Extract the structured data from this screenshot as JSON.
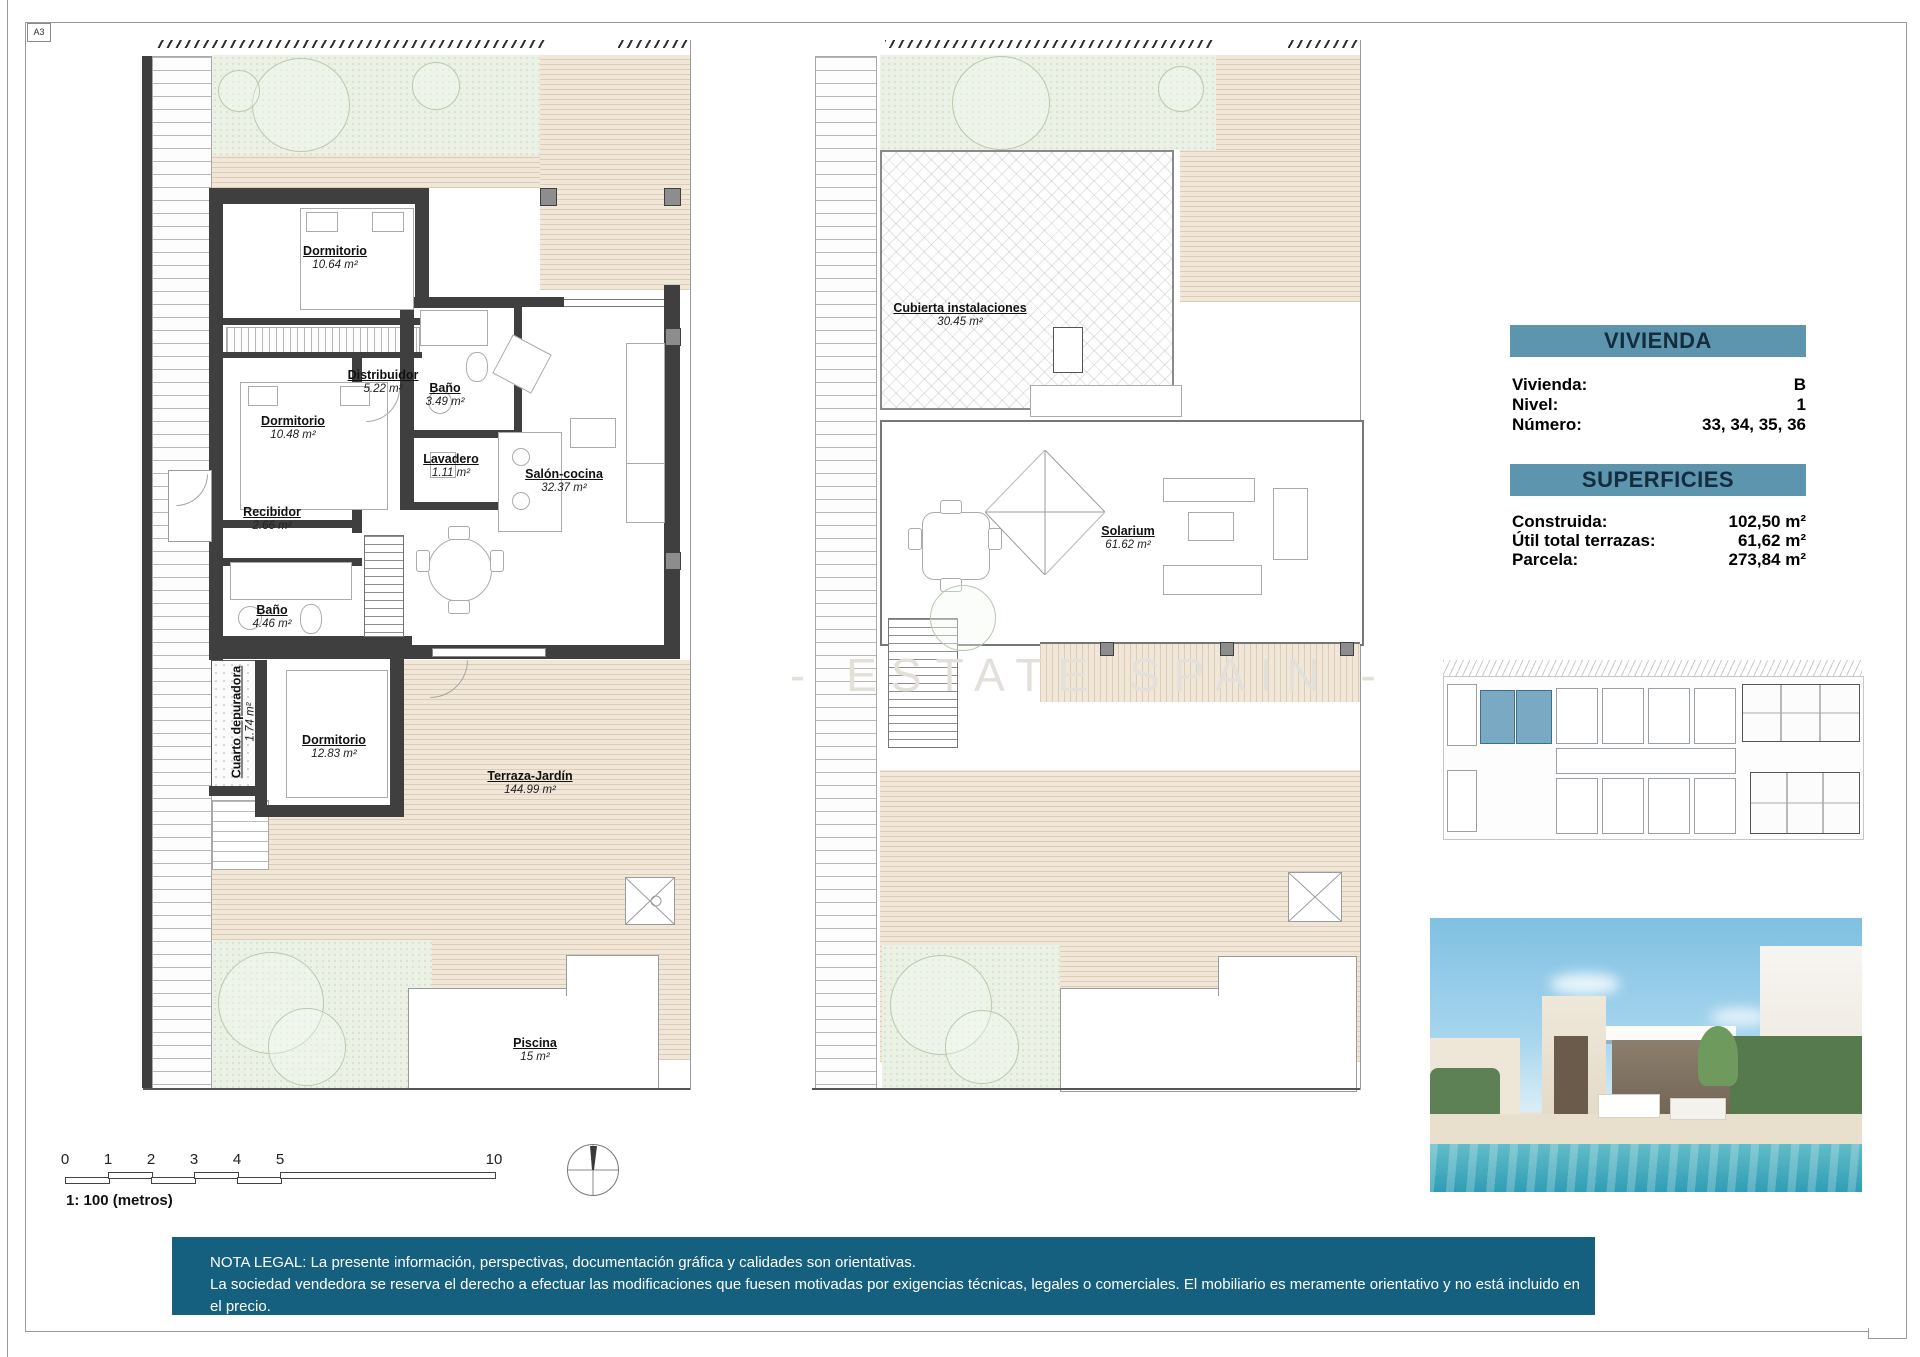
{
  "sheet": {
    "format_label": "A3",
    "scale_label": "1: 100 (metros)"
  },
  "watermark": "- ESTATE SPAIN -",
  "colors": {
    "table_header_bg": "#5d95ae",
    "table_header_text": "#132c3e",
    "legal_bar_bg": "#16607f",
    "highlighted_unit": "#7aa9c4",
    "wall": "#3f3f3f",
    "deck_beige": "#f0e7d8",
    "garden_green": "#ebf1e5"
  },
  "plans": {
    "ground": {
      "rooms": [
        {
          "name": "Dormitorio",
          "area": "10.64 m²"
        },
        {
          "name": "Distribuidor",
          "area": "5.22 m²"
        },
        {
          "name": "Baño",
          "area": "3.49 m²"
        },
        {
          "name": "Dormitorio",
          "area": "10.48 m²"
        },
        {
          "name": "Lavadero",
          "area": "1.11 m²"
        },
        {
          "name": "Salón-cocina",
          "area": "32.37 m²"
        },
        {
          "name": "Recibidor",
          "area": "2.66 m²"
        },
        {
          "name": "Baño",
          "area": "4.46 m²"
        },
        {
          "name": "Cuarto depuradora",
          "area": "1.74 m²"
        },
        {
          "name": "Dormitorio",
          "area": "12.83 m²"
        },
        {
          "name": "Terraza-Jardín",
          "area": "144.99 m²"
        },
        {
          "name": "Piscina",
          "area": "15 m²"
        }
      ]
    },
    "roof": {
      "rooms": [
        {
          "name": "Cubierta instalaciones",
          "area": "30.45 m²"
        },
        {
          "name": "Solarium",
          "area": "61.62 m²"
        }
      ]
    }
  },
  "vivienda_table": {
    "title": "VIVIENDA",
    "rows": [
      {
        "label": "Vivienda:",
        "value": "B"
      },
      {
        "label": "Nivel:",
        "value": "1"
      },
      {
        "label": "Número:",
        "value": "33, 34, 35, 36"
      }
    ]
  },
  "superficies_table": {
    "title": "SUPERFICIES",
    "rows": [
      {
        "label": "Construida:",
        "value": "102,50 m²"
      },
      {
        "label": "Útil total terrazas:",
        "value": "61,62 m²"
      },
      {
        "label": "Parcela:",
        "value": "273,84 m²"
      }
    ]
  },
  "scale_bar": {
    "ticks": [
      "0",
      "1",
      "2",
      "3",
      "4",
      "5",
      "10"
    ]
  },
  "legal": {
    "line1": "NOTA LEGAL: La presente información, perspectivas, documentación gráfica y calidades son orientativas.",
    "line2": "La sociedad vendedora se reserva el derecho a efectuar las modificaciones que fuesen motivadas por exigencias técnicas, legales o comerciales. El mobiliario es meramente orientativo y no está incluido en el precio."
  }
}
